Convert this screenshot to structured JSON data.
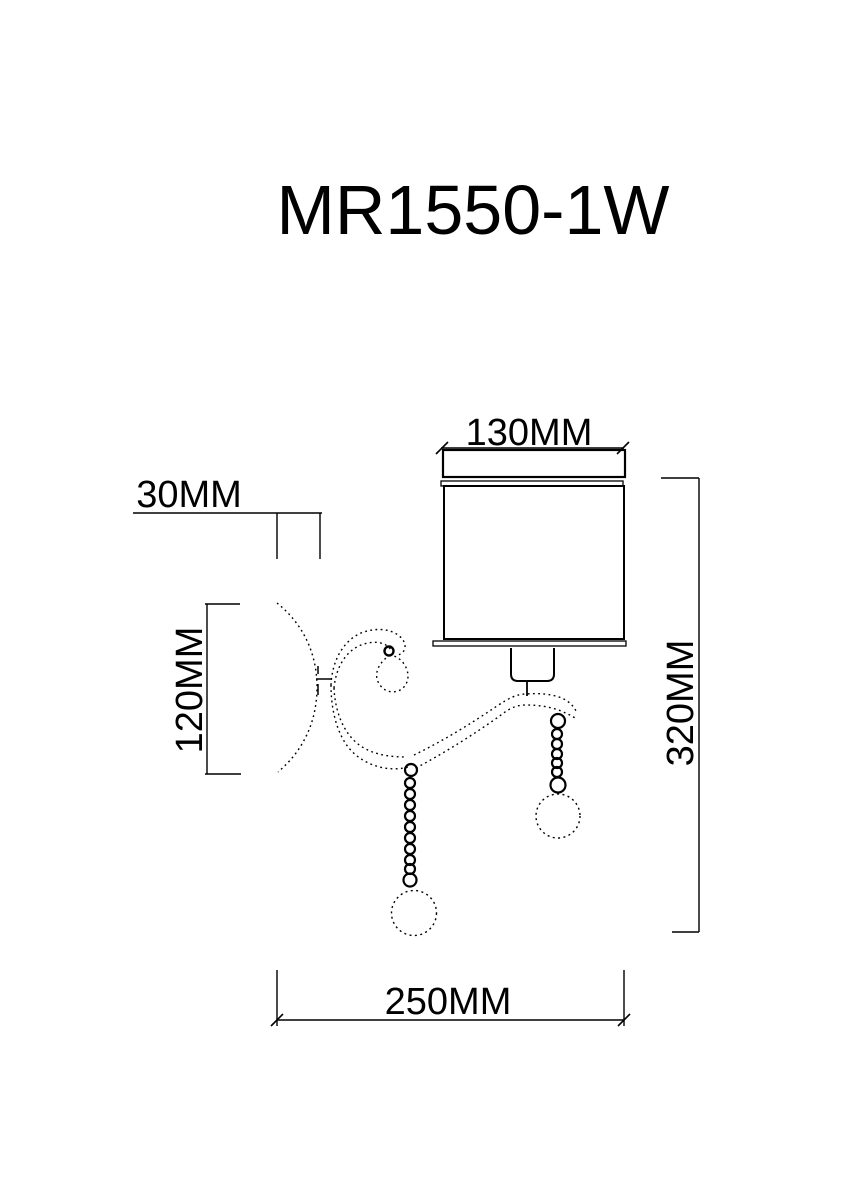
{
  "title": "MR1550-1W",
  "drawing": {
    "type": "wall-sconce-technical-drawing",
    "labels": {
      "shade_width": "130MM",
      "wall_depth": "30MM",
      "backplate_height": "120MM",
      "overall_height": "320MM",
      "overall_width": "250MM"
    }
  },
  "colors": {
    "line": "#000000",
    "background": "#ffffff"
  }
}
